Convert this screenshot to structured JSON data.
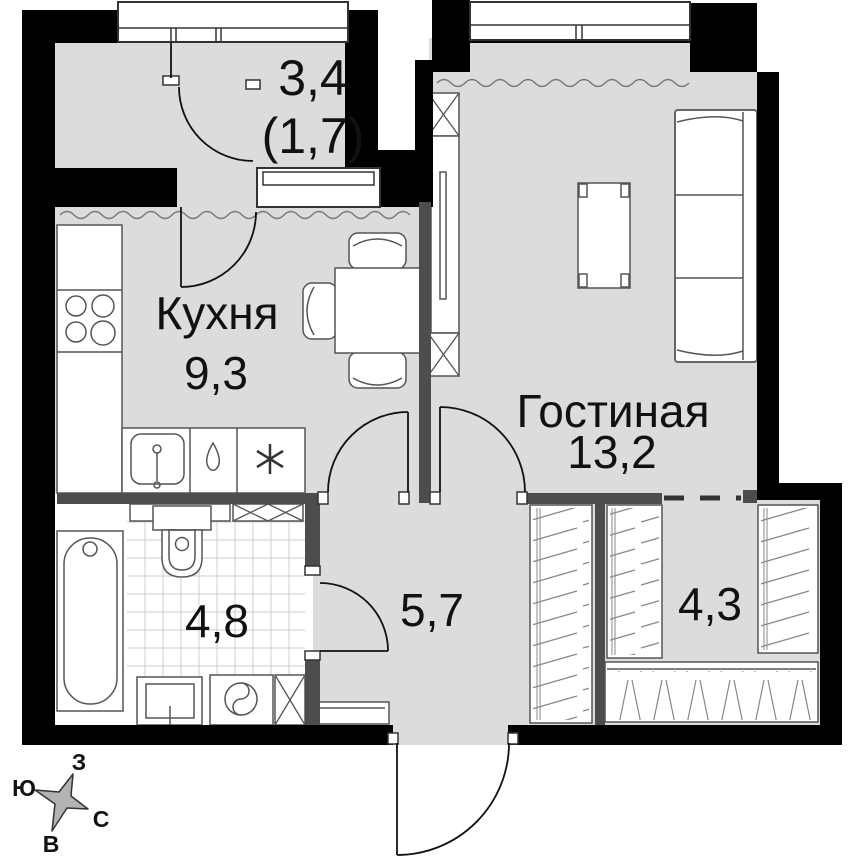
{
  "plan": {
    "type": "apartment-floor-plan",
    "rooms": [
      {
        "id": "balcony",
        "name": "",
        "area": "3,4",
        "area_reduced": "(1,7)"
      },
      {
        "id": "kitchen",
        "name": "Кухня",
        "area": "9,3"
      },
      {
        "id": "living",
        "name": "Гостиная",
        "area": "13,2"
      },
      {
        "id": "bathroom",
        "name": "",
        "area": "4,8"
      },
      {
        "id": "hallway",
        "name": "",
        "area": "5,7"
      },
      {
        "id": "wardrobe",
        "name": "",
        "area": "4,3"
      }
    ],
    "compass": {
      "top": "З",
      "left": "Ю",
      "right": "С",
      "bottom": "В"
    },
    "icons": [
      "stove-burners-icon",
      "sink-icon",
      "water-drop-icon",
      "snowflake-icon",
      "vent-shaft-x-icon",
      "washing-machine-icon"
    ],
    "colors": {
      "outer_wall": "#000000",
      "partition": "#4d4d4d",
      "floor": "#dcdcdc",
      "tile_grid": "#cccccc",
      "furniture_outline": "#555555",
      "compass_fill": "#b3b3b3"
    }
  }
}
